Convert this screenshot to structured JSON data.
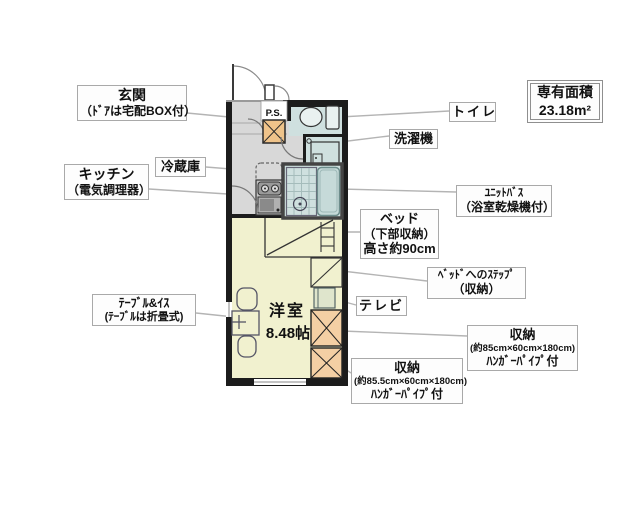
{
  "plan": {
    "ps_label": "P.S.",
    "room_name": "洋室",
    "room_size": "8.48帖"
  },
  "area_box": {
    "line1": "専有面積",
    "line2": "23.18m²"
  },
  "labels": {
    "entrance": {
      "lines": [
        "玄関",
        "（ﾄﾞｱは宅配BOX付）"
      ]
    },
    "refrigerator": {
      "lines": [
        "冷蔵庫"
      ]
    },
    "kitchen": {
      "lines": [
        "キッチン",
        "（電気調理器）"
      ]
    },
    "table": {
      "lines": [
        "ﾃｰﾌﾞﾙ&ｲｽ",
        "(ﾃｰﾌﾞﾙは折畳式)"
      ]
    },
    "toilet": {
      "lines": [
        "トイレ"
      ]
    },
    "washer": {
      "lines": [
        "洗濯機"
      ]
    },
    "unit_bath": {
      "lines": [
        "ﾕﾆｯﾄﾊﾞｽ",
        "（浴室乾燥機付）"
      ]
    },
    "bed": {
      "lines": [
        "ベッド",
        "（下部収納）",
        "高さ約90cm"
      ]
    },
    "bed_step": {
      "lines": [
        "ﾍﾞｯﾄﾞへのｽﾃｯﾌﾟ",
        "（収納）"
      ]
    },
    "tv": {
      "lines": [
        "テレビ"
      ]
    },
    "storage_right": {
      "lines": [
        "収納",
        "(約85cm×60cm×180cm)",
        "ﾊﾝｶﾞｰﾊﾟｲﾌﾟ付"
      ]
    },
    "storage_bottom": {
      "lines": [
        "収納",
        "(約85.5cm×60cm×180cm)",
        "ﾊﾝｶﾞｰﾊﾟｲﾌﾟ付"
      ]
    }
  },
  "colors": {
    "wall": "#1c1c1c",
    "floor_gray": "#d8d8d8",
    "water_blue": "#cfe0df",
    "room_yellow": "#f1f1cf",
    "closet_orange": "#f4cfa4",
    "ps_tan": "#efc38a",
    "tv_green": "#dfe5cc",
    "label_border": "#a9a9a9",
    "leader_line": "#b4b4b4"
  }
}
